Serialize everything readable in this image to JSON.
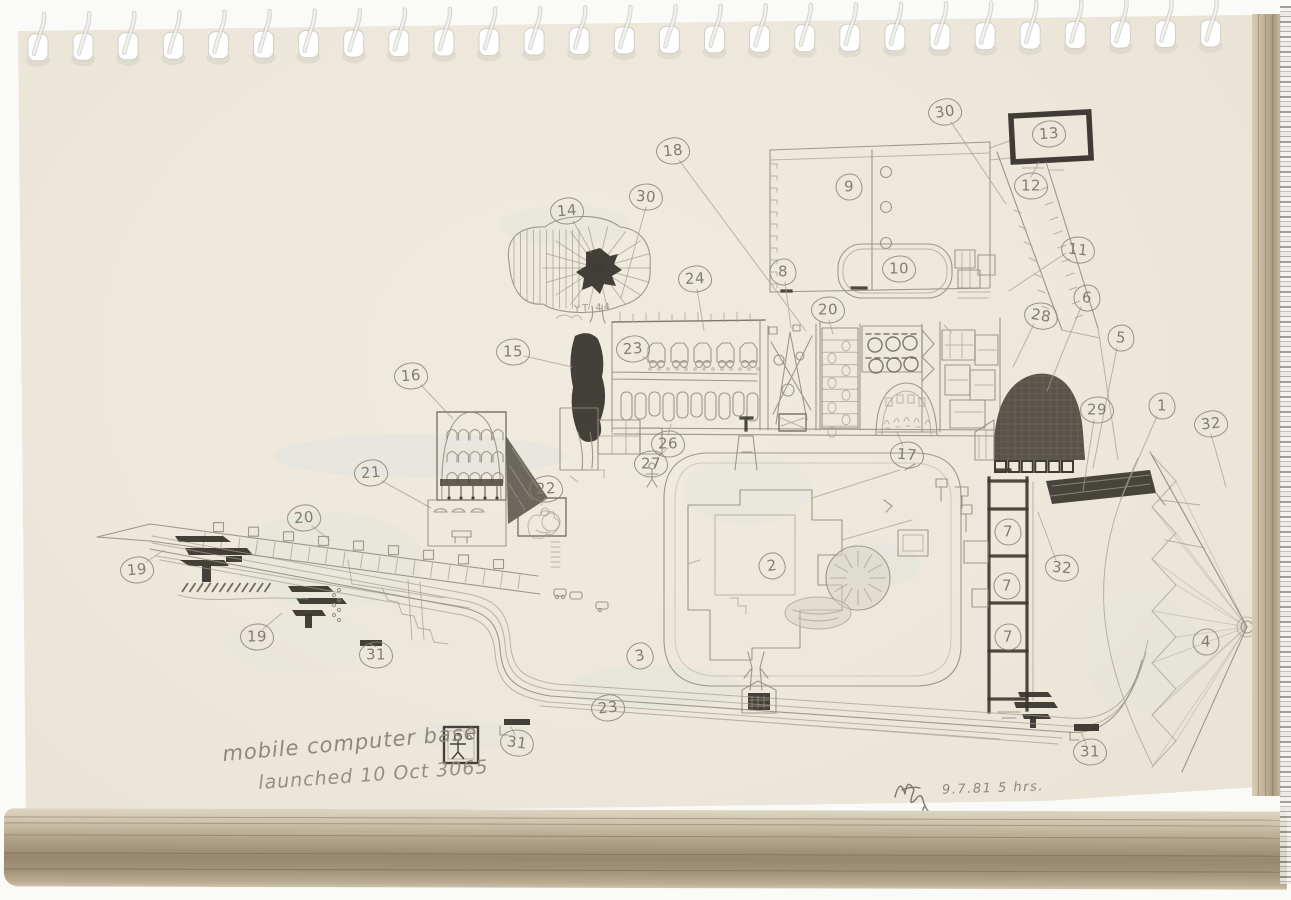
{
  "page": {
    "caption_line1": "mobile computer base",
    "caption_line2": "launched 10 Oct 3065",
    "scale_label": "6'",
    "tree_label": "YT 44",
    "date_note": "9.7.81  5 hrs."
  },
  "colors": {
    "paper": "#ece7da",
    "pencil": "#8f8979",
    "dark_pencil": "#3e3b33",
    "page_edge": "#b5a68c"
  },
  "callouts": [
    {
      "label": "30",
      "x": 945,
      "y": 112,
      "r": -8
    },
    {
      "label": "13",
      "x": 1049,
      "y": 134,
      "r": -4
    },
    {
      "label": "12",
      "x": 1031,
      "y": 186,
      "r": 0
    },
    {
      "label": "18",
      "x": 673,
      "y": 151,
      "r": -6
    },
    {
      "label": "9",
      "x": 849,
      "y": 187,
      "r": 0
    },
    {
      "label": "14",
      "x": 567,
      "y": 211,
      "r": -5
    },
    {
      "label": "30",
      "x": 646,
      "y": 197,
      "r": 4
    },
    {
      "label": "24",
      "x": 695,
      "y": 279,
      "r": -3
    },
    {
      "label": "8",
      "x": 783,
      "y": 272,
      "r": 0
    },
    {
      "label": "10",
      "x": 899,
      "y": 269,
      "r": 0
    },
    {
      "label": "20",
      "x": 828,
      "y": 310,
      "r": 0
    },
    {
      "label": "11",
      "x": 1078,
      "y": 250,
      "r": 6
    },
    {
      "label": "6",
      "x": 1087,
      "y": 298,
      "r": 8
    },
    {
      "label": "28",
      "x": 1041,
      "y": 316,
      "r": 10
    },
    {
      "label": "5",
      "x": 1121,
      "y": 338,
      "r": 6
    },
    {
      "label": "15",
      "x": 513,
      "y": 352,
      "r": 0
    },
    {
      "label": "23",
      "x": 633,
      "y": 349,
      "r": -4
    },
    {
      "label": "16",
      "x": 411,
      "y": 376,
      "r": -4
    },
    {
      "label": "29",
      "x": 1097,
      "y": 410,
      "r": 0
    },
    {
      "label": "1",
      "x": 1162,
      "y": 406,
      "r": 0
    },
    {
      "label": "32",
      "x": 1211,
      "y": 424,
      "r": -6
    },
    {
      "label": "26",
      "x": 668,
      "y": 444,
      "r": 0
    },
    {
      "label": "27",
      "x": 651,
      "y": 464,
      "r": 0
    },
    {
      "label": "17",
      "x": 907,
      "y": 455,
      "r": 5
    },
    {
      "label": "21",
      "x": 371,
      "y": 473,
      "r": -5
    },
    {
      "label": "22",
      "x": 546,
      "y": 489,
      "r": -3
    },
    {
      "label": "20",
      "x": 304,
      "y": 518,
      "r": -5
    },
    {
      "label": "7",
      "x": 1008,
      "y": 532,
      "r": 0
    },
    {
      "label": "19",
      "x": 137,
      "y": 570,
      "r": -5
    },
    {
      "label": "2",
      "x": 772,
      "y": 566,
      "r": -8
    },
    {
      "label": "32",
      "x": 1062,
      "y": 568,
      "r": 5
    },
    {
      "label": "7",
      "x": 1007,
      "y": 586,
      "r": 0
    },
    {
      "label": "7",
      "x": 1008,
      "y": 637,
      "r": 0
    },
    {
      "label": "19",
      "x": 257,
      "y": 637,
      "r": 0
    },
    {
      "label": "3",
      "x": 640,
      "y": 656,
      "r": -10
    },
    {
      "label": "31",
      "x": 376,
      "y": 655,
      "r": 0
    },
    {
      "label": "4",
      "x": 1206,
      "y": 642,
      "r": 0
    },
    {
      "label": "23",
      "x": 608,
      "y": 708,
      "r": -6
    },
    {
      "label": "31",
      "x": 517,
      "y": 743,
      "r": 8
    },
    {
      "label": "31",
      "x": 1090,
      "y": 752,
      "r": 0
    }
  ]
}
